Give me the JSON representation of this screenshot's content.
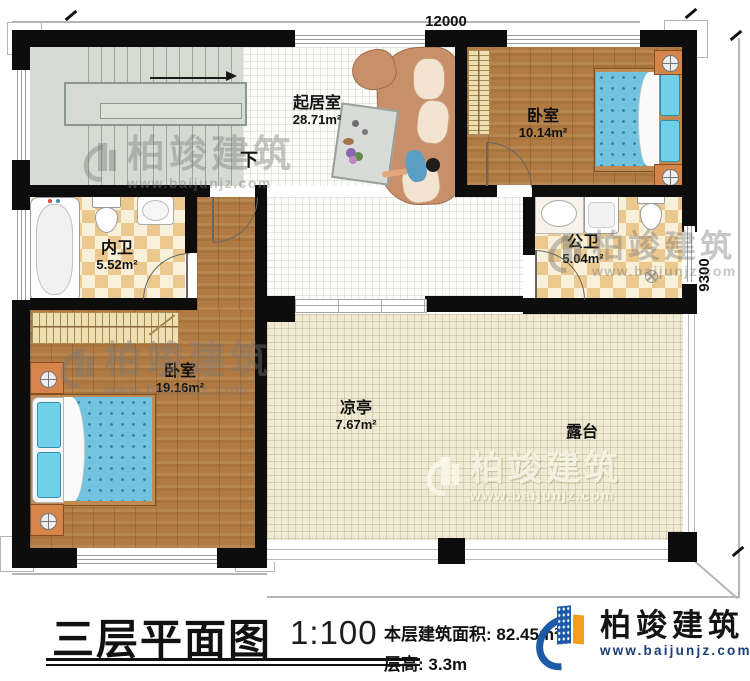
{
  "plan": {
    "dimension_top": "12000",
    "dimension_right": "9300",
    "stairs_down_label": "下",
    "rooms": [
      {
        "name": "起居室",
        "area": "28.71m²"
      },
      {
        "name": "卧室",
        "area": "10.14m²"
      },
      {
        "name": "内卫",
        "area": "5.52m²"
      },
      {
        "name": "公卫",
        "area": "5.04m²"
      },
      {
        "name": "卧室",
        "area": "19.16m²"
      },
      {
        "name": "凉亭",
        "area": "7.67m²"
      },
      {
        "name": "露台",
        "area": ""
      }
    ]
  },
  "watermark": {
    "name": "柏竣建筑",
    "website": "www.baijunjz.com"
  },
  "titleblock": {
    "plan_title": "三层平面图",
    "scale": "1:100",
    "area_label": "本层建筑面积:",
    "area_value": "82.45m²",
    "height_label": "层高:",
    "height_value": "3.3m"
  },
  "logo": {
    "name": "柏竣建筑",
    "website": "www.baijunjz.com"
  },
  "colors": {
    "wall": "#0d0d0d",
    "wood_floor": "#b07a42",
    "tile_light": "#fcfcf9",
    "terrace_tile": "#f0ead4",
    "checker_tan": "#eac88e",
    "stair": "#d5dbd1",
    "bed_blue": "#72c3de",
    "sofa_brown": "#c8906a",
    "brand_blue": "#1b5aa6",
    "brand_orange": "#f29d1e",
    "watermark_gray": "#7a7a7a"
  }
}
